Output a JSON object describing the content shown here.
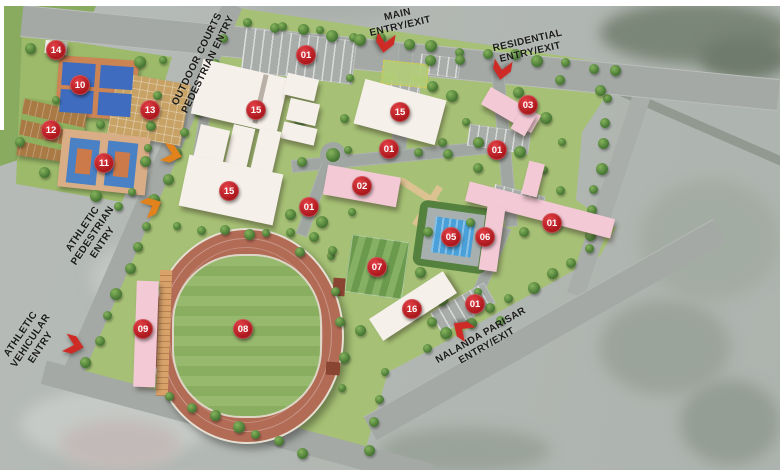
{
  "map": {
    "entries": [
      {
        "id": "main-entry",
        "lines": [
          "MAIN",
          "ENTRY/EXIT"
        ],
        "x": 399,
        "y": 21,
        "rotate": -13,
        "arrow": {
          "x": 385,
          "y": 43,
          "rotate": 100,
          "color": "#cf2b26"
        }
      },
      {
        "id": "residential-entry",
        "lines": [
          "RESIDENTIAL",
          "ENTRY/EXIT"
        ],
        "x": 529,
        "y": 47,
        "rotate": -13,
        "arrow": {
          "x": 502,
          "y": 70,
          "rotate": 100,
          "color": "#cf2b26"
        }
      },
      {
        "id": "outdoor-courts-pedestrian-entry",
        "lines": [
          "OUTDOOR COURTS",
          "PEDESTRIAN ENTRY"
        ],
        "x": 203,
        "y": 62,
        "rotate": -64,
        "arrow": {
          "x": 172,
          "y": 154,
          "rotate": 15,
          "color": "#e2821c"
        }
      },
      {
        "id": "athletic-pedestrian-entry",
        "lines": [
          "ATHLETIC",
          "PEDESTRIAN",
          "ENTRY"
        ],
        "x": 93,
        "y": 236,
        "rotate": -56,
        "arrow": {
          "x": 152,
          "y": 206,
          "rotate": -25,
          "color": "#e2821c"
        }
      },
      {
        "id": "athletic-vehicular-entry",
        "lines": [
          "ATHLETIC",
          "VEHICULAR",
          "ENTRY"
        ],
        "x": 31,
        "y": 341,
        "rotate": -56,
        "arrow": {
          "x": 74,
          "y": 345,
          "rotate": 15,
          "color": "#cf2b26"
        }
      },
      {
        "id": "nalanda-parisar-entry",
        "lines": [
          "NALANDA PARISAR",
          "ENTRY/EXIT"
        ],
        "x": 484,
        "y": 341,
        "rotate": -30,
        "arrow": {
          "x": 462,
          "y": 329,
          "rotate": -145,
          "color": "#cf2b26"
        }
      }
    ],
    "badges": [
      {
        "label": "14",
        "x": 56,
        "y": 50
      },
      {
        "label": "10",
        "x": 80,
        "y": 85
      },
      {
        "label": "13",
        "x": 150,
        "y": 110
      },
      {
        "label": "12",
        "x": 51,
        "y": 130
      },
      {
        "label": "11",
        "x": 104,
        "y": 163
      },
      {
        "label": "15",
        "x": 256,
        "y": 110
      },
      {
        "label": "15",
        "x": 229,
        "y": 191
      },
      {
        "label": "15",
        "x": 400,
        "y": 112
      },
      {
        "label": "01",
        "x": 306,
        "y": 55
      },
      {
        "label": "01",
        "x": 389,
        "y": 149
      },
      {
        "label": "01",
        "x": 497,
        "y": 150
      },
      {
        "label": "01",
        "x": 309,
        "y": 207
      },
      {
        "label": "01",
        "x": 552,
        "y": 223
      },
      {
        "label": "01",
        "x": 475,
        "y": 304
      },
      {
        "label": "02",
        "x": 362,
        "y": 186
      },
      {
        "label": "03",
        "x": 528,
        "y": 105
      },
      {
        "label": "05",
        "x": 451,
        "y": 237
      },
      {
        "label": "06",
        "x": 485,
        "y": 237
      },
      {
        "label": "07",
        "x": 377,
        "y": 267
      },
      {
        "label": "16",
        "x": 412,
        "y": 309
      },
      {
        "label": "08",
        "x": 243,
        "y": 329
      },
      {
        "label": "09",
        "x": 143,
        "y": 329
      }
    ],
    "colors": {
      "badge_red": "#b01b20",
      "entry_arrow_red": "#cf2b26",
      "entry_arrow_orange": "#e2821c",
      "site_green": "#a6c175",
      "track_terracotta": "#b26b55",
      "building_white": "#f6f0ea",
      "building_pink": "#f3c9d6",
      "pool_blue": "#4aa0d8",
      "court_blue": "#4173bf"
    }
  }
}
